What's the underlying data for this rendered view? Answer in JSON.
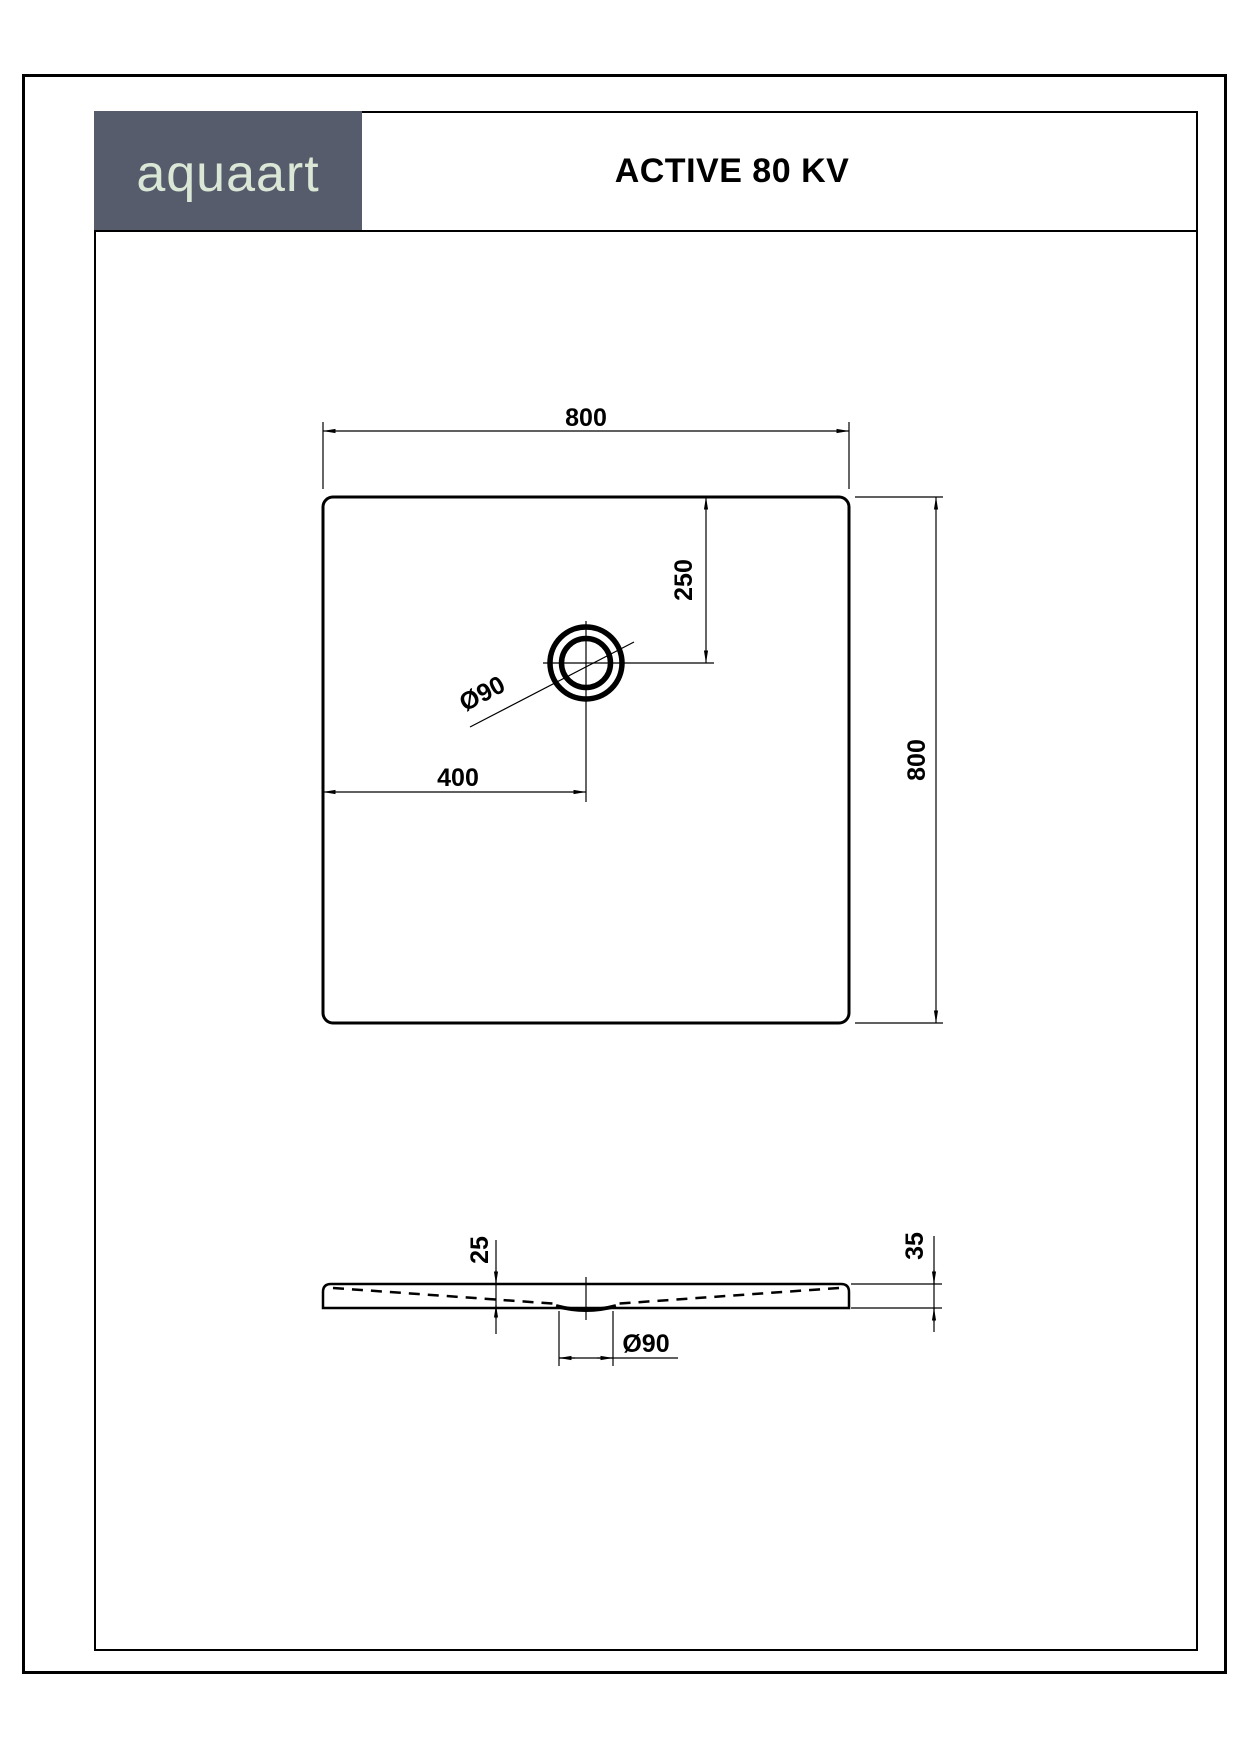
{
  "header": {
    "logo_text": "aquaart",
    "title": "ACTIVE 80 KV"
  },
  "colors": {
    "logo_background": "#565C6B",
    "logo_text_color": "#DBE7D6",
    "line_color": "#000000",
    "paper_color": "#FFFFFF"
  },
  "top_view": {
    "width_label": "800",
    "height_label": "800",
    "drain_offset_from_left_label": "400",
    "drain_offset_from_top_label": "250",
    "drain_diameter_label": "Ø90"
  },
  "side_view": {
    "inner_depth_label": "25",
    "edge_height_label": "35",
    "drain_diameter_label": "Ø90"
  }
}
